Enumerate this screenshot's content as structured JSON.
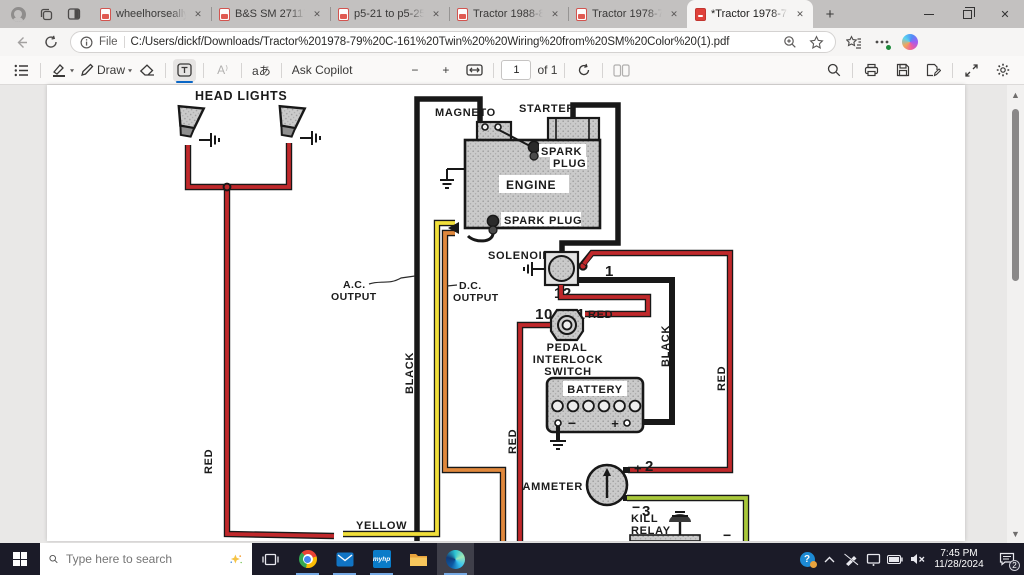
{
  "browser": {
    "tabs": [
      {
        "label": "wheelhorseallyears.p",
        "close": "✕"
      },
      {
        "label": "B&S SM 271172 Twi",
        "close": "✕"
      },
      {
        "label": "p5-21 to p5-25 199",
        "close": "✕"
      },
      {
        "label": "Tractor 1988-89 208",
        "close": "✕"
      },
      {
        "label": "Tractor 1978-79 C-1",
        "close": "✕"
      },
      {
        "label": "*Tractor 1978-79 C-1",
        "close": "✕"
      }
    ],
    "new_tab_glyph": "+",
    "window_close_glyph": "✕",
    "address": {
      "file_scheme_label": "File",
      "url": "C:/Users/dickf/Downloads/Tractor%201978-79%20C-161%20Twin%20%20Wiring%20from%20SM%20Color%20(1).pdf"
    }
  },
  "pdf_toolbar": {
    "draw_label": "Draw",
    "chevron_glyph": "▼",
    "ask_copilot_label": "Ask Copilot",
    "zoom_out_glyph": "−",
    "zoom_in_glyph": "+",
    "page_value": "1",
    "page_count_label": "of 1",
    "read_aloud_glyph": "A⁾",
    "translate_glyph": "aあ"
  },
  "scrollbar": {
    "up_glyph": "▲",
    "down_glyph": "▼"
  },
  "diagram": {
    "head_lights_label": "HEAD LIGHTS",
    "magneto_label": "MAGNETO",
    "starter_label": "STARTER",
    "spark_plug_top_line1": "SPARK",
    "spark_plug_top_line2": "PLUG",
    "engine_label": "ENGINE",
    "spark_plug_bottom_label": "SPARK PLUG",
    "solenoid_label": "SOLENOID",
    "ac_line1": "A.C.",
    "ac_line2": "OUTPUT",
    "dc_line1": "D.C.",
    "dc_line2": "OUTPUT",
    "pedal_line1": "PEDAL",
    "pedal_line2": "INTERLOCK",
    "pedal_line3": "SWITCH",
    "battery_label": "BATTERY",
    "ammeter_label": "AMMETER",
    "kill_relay_line1": "KILL",
    "kill_relay_line2": "RELAY",
    "wire_labels": {
      "red_left": "RED",
      "black_left": "BLACK",
      "yellow": "YELLOW",
      "red_mid": "RED",
      "black_right": "BLACK",
      "red_right": "RED",
      "red_after_11": "RED"
    },
    "annotations": {
      "n1": "1",
      "n2": "2",
      "n3": "3",
      "n10": "10",
      "n11": "11",
      "n12": "12"
    },
    "signs": {
      "battery_minus": "−",
      "battery_plus": "+",
      "ammeter_plus": "+",
      "ammeter_minus": "−",
      "kill_minus": "−"
    },
    "colors": {
      "red": "#c0282b",
      "yellow": "#f1df3a",
      "orange": "#e0883c",
      "green": "#a9c83b",
      "annotation_blue": "#2e7ee0"
    }
  },
  "taskbar": {
    "search_placeholder": "Type here to search",
    "myhp_label": "myhp",
    "time": "7:45 PM",
    "date": "11/28/2024",
    "notification_count": "2"
  }
}
